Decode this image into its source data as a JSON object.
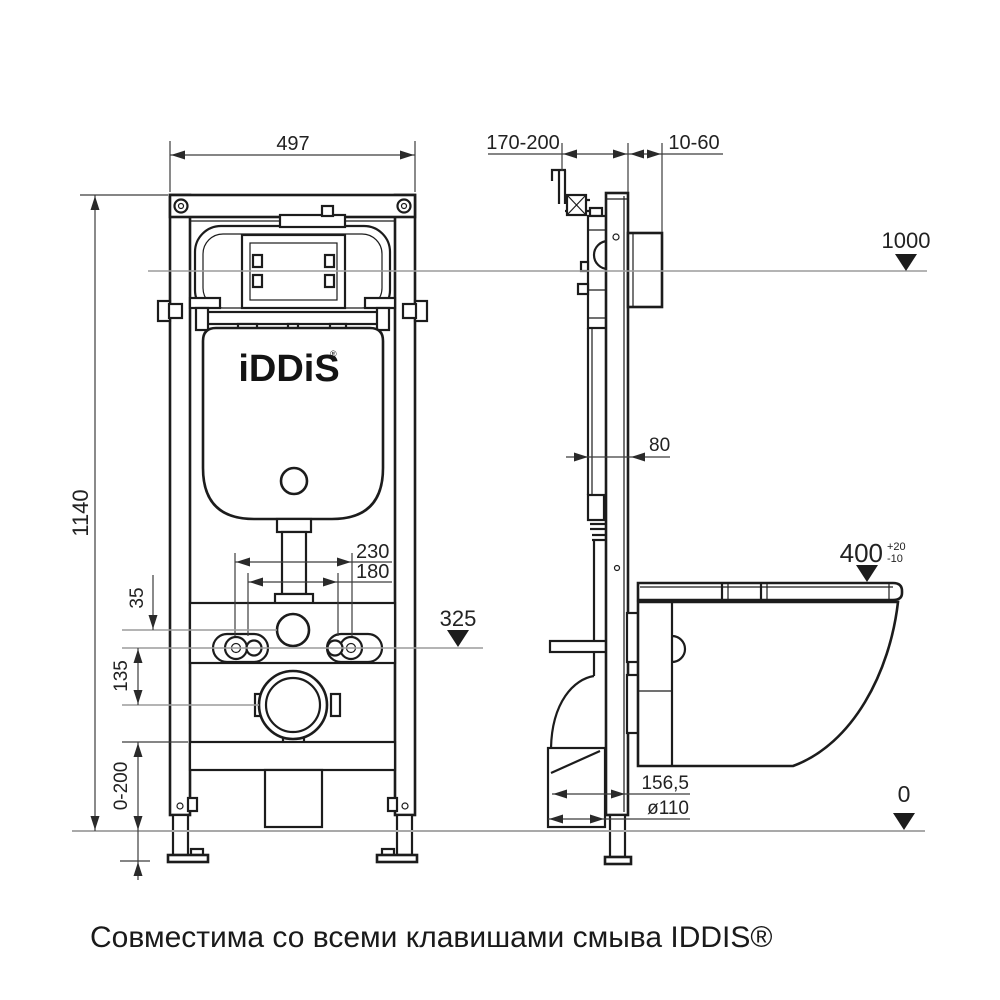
{
  "drawing": {
    "caption": "Совместима со всеми клавишами смыва IDDIS®",
    "brand": {
      "logo": "iDDiS",
      "mark": "®"
    },
    "front_view": {
      "width": "497",
      "height": "1140",
      "bolt_spacing_outer": "230",
      "bolt_spacing_inner": "180",
      "hole_offset": "35",
      "drain_offset": "135",
      "leg_adjust": "0-200"
    },
    "side_view": {
      "depth_range": "170-200",
      "wall_gap": "10-60",
      "frame_depth": "80",
      "outlet_offset": "156,5",
      "outlet_diameter": "ø110"
    },
    "levels": {
      "top": "1000",
      "flush": "325",
      "bowl": "400",
      "bowl_tol_plus": "+20",
      "bowl_tol_minus": "-10",
      "floor": "0"
    },
    "colors": {
      "line": "#1c1c1c",
      "dimension": "#3c3c3c",
      "level_line": "#9c9c9c",
      "background": "#ffffff"
    }
  }
}
